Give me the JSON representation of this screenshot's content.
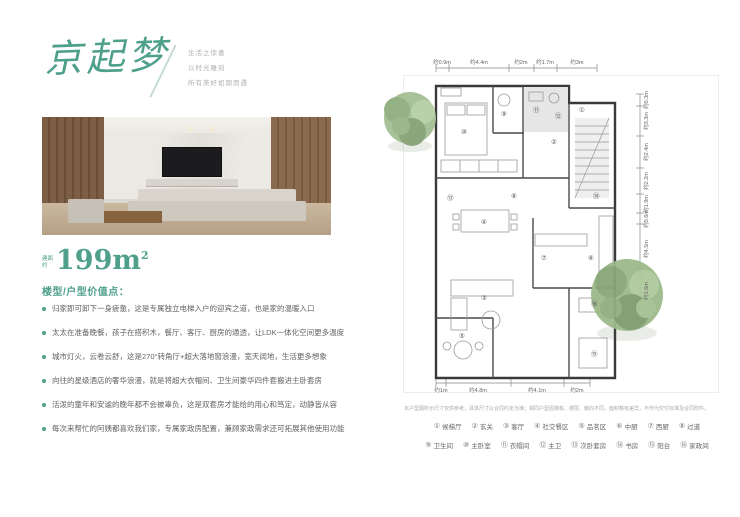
{
  "brand": {
    "logo": "京起梦",
    "tagline": [
      "生活之惊喜",
      "以时光雕刻",
      "所有美好如期而遇"
    ]
  },
  "area": {
    "prefix": "建面约",
    "value": "199m",
    "sup": "2"
  },
  "section_heading": "楼型/户型价值点：",
  "bullets": [
    "归家即可卸下一身疲惫，这是专属独立电梯入户的迎宾之道，也是家的温暖入口",
    "太太在准备晚餐，孩子在搭积木，餐厅、客厅、厨房的通透，让LDK一体化空间更多温度",
    "城市灯火，云卷云舒，这是270°转角厅+超大落地窗浪漫，宽天阔地，生活更多想象",
    "向往的星级酒店的奢华浪漫，就是将超大衣帽间、卫生间豪华四件套搬进主卧套房",
    "活泼的童年和安谧的晚年都不会被辜负，这是双套房才能给的用心和笃定，动静皆从容",
    "每次来帮忙的阿姨都喜欢我们家，专属家政房配置，兼顾家政需求还可拓展其他使用功能"
  ],
  "plan": {
    "dims_top": [
      "约0.9m",
      "约4.4m",
      "约2m",
      "约1.7m",
      "约3m"
    ],
    "dims_right": [
      "约0.3m",
      "约3.3m",
      "约2.4m",
      "约2.2m",
      "约1.9m",
      "约0.6m",
      "约4.5m",
      "约1.6m"
    ],
    "dims_bottom": [
      "约1m",
      "约4.8m",
      "约4.1m",
      "约2m"
    ],
    "marks": [
      "①",
      "②",
      "③",
      "④",
      "⑤",
      "⑥",
      "⑦",
      "⑧",
      "⑨",
      "⑩",
      "⑪",
      "⑫",
      "⑬",
      "⑭",
      "⑮",
      "⑯"
    ]
  },
  "disclaimer": "本户型图所示尺寸仅供参考，具体尺寸以合同约定为准；相同户型因楼栋、楼层、朝向不同，面积略有差异，不作为交付标准及合同附件。",
  "legend": {
    "row1": [
      {
        "num": "①",
        "label": "候梯厅"
      },
      {
        "num": "②",
        "label": "玄关"
      },
      {
        "num": "③",
        "label": "客厅"
      },
      {
        "num": "④",
        "label": "社交餐区"
      },
      {
        "num": "⑤",
        "label": "品茗区"
      },
      {
        "num": "⑥",
        "label": "中厨"
      },
      {
        "num": "⑦",
        "label": "西厨"
      },
      {
        "num": "⑧",
        "label": "过道"
      }
    ],
    "row2": [
      {
        "num": "⑨",
        "label": "卫生间"
      },
      {
        "num": "⑩",
        "label": "主卧室"
      },
      {
        "num": "⑪",
        "label": "衣帽间"
      },
      {
        "num": "⑫",
        "label": "主卫"
      },
      {
        "num": "⑬",
        "label": "次卧套房"
      },
      {
        "num": "⑭",
        "label": "书房"
      },
      {
        "num": "⑮",
        "label": "阳台"
      },
      {
        "num": "⑯",
        "label": "家政间"
      }
    ]
  }
}
